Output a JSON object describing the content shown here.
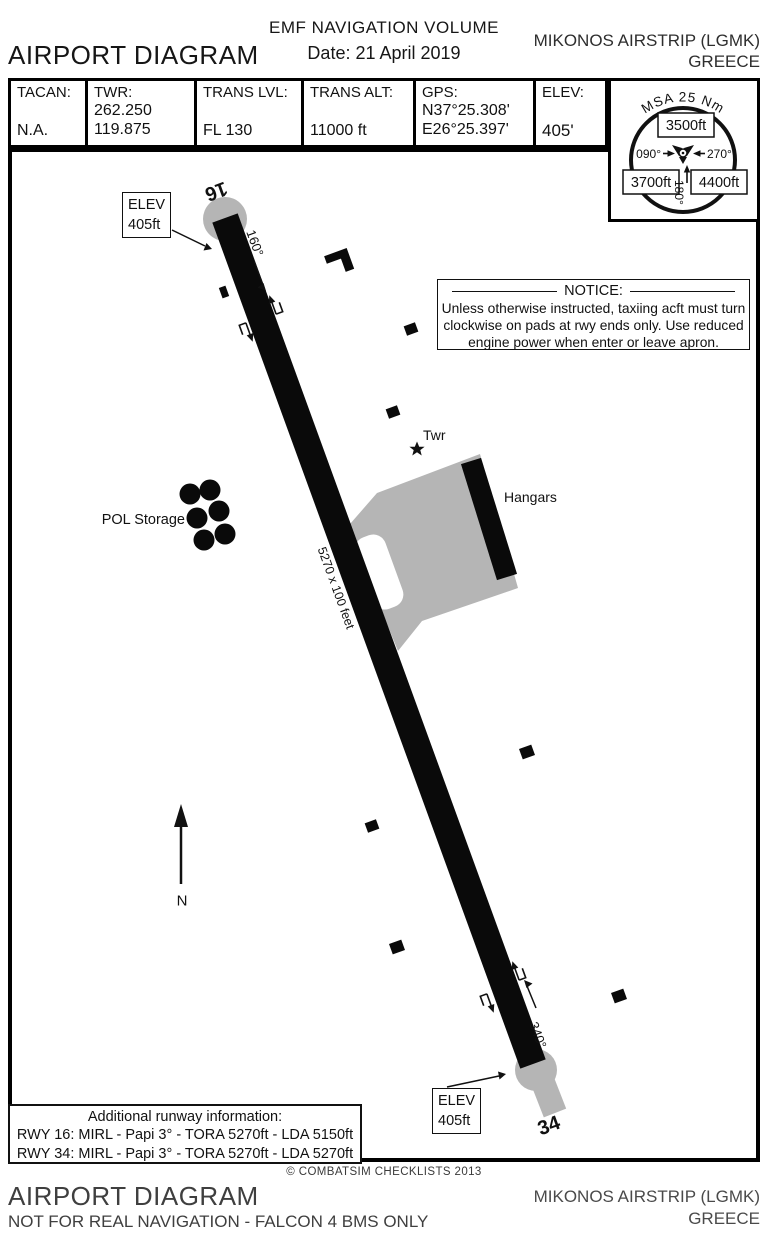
{
  "header": {
    "volume_title": "EMF NAVIGATION VOLUME",
    "date_label": "Date:",
    "date_value": "21 April 2019",
    "page_title": "AIRPORT DIAGRAM",
    "airport_name": "MIKONOS AIRSTRIP (LGMK)",
    "country": "GREECE"
  },
  "info_table": {
    "tacan_label": "TACAN:",
    "tacan_value": "N.A.",
    "twr_label": "TWR:",
    "twr_freq_uhf": "262.250",
    "twr_freq_vhf": "119.875",
    "trans_lvl_label": "TRANS LVL:",
    "trans_lvl_value": "FL 130",
    "trans_alt_label": "TRANS ALT:",
    "trans_alt_value": "11000 ft",
    "gps_label": "GPS:",
    "gps_lat": "N37°25.308'",
    "gps_lon": "E26°25.397'",
    "elev_label": "ELEV:",
    "elev_value": "405'"
  },
  "msa": {
    "title": "MSA 25 Nm",
    "sector_north": "3500ft",
    "bearing_west": "090°",
    "bearing_east": "270°",
    "sector_southwest": "3700ft",
    "sector_southeast": "4400ft",
    "bearing_south": "180°"
  },
  "map": {
    "rwy16_label": "16",
    "rwy34_label": "34",
    "rwy16_heading": "160°",
    "rwy34_heading": "340°",
    "runway_dimensions": "5270 x 100 feet",
    "elev_line1": "ELEV",
    "elev_line2": "405ft",
    "pol_label": "POL Storage",
    "twr_label": "Twr",
    "hangars_label": "Hangars",
    "north_label": "N",
    "notice_title": "NOTICE:",
    "notice_line1": "Unless otherwise instructed, taxiing acft must turn",
    "notice_line2": "clockwise on pads at rwy ends only. Use reduced",
    "notice_line3": "engine power when enter or leave apron.",
    "addinfo_title": "Additional runway information:",
    "addinfo_rwy16": "RWY 16: MIRL - Papi 3° - TORA 5270ft - LDA 5150ft",
    "addinfo_rwy34": "RWY 34: MIRL - Papi 3° - TORA 5270ft - LDA 5270ft"
  },
  "footer": {
    "copyright": "© COMBATSIM CHECKLISTS 2013",
    "page_title": "AIRPORT DIAGRAM",
    "disclaimer": "NOT FOR REAL NAVIGATION - FALCON 4 BMS ONLY",
    "airport_name": "MIKONOS AIRSTRIP (LGMK)",
    "country": "GREECE"
  },
  "colors": {
    "ink": "#111111",
    "pavement_gray": "#b5b5b5",
    "runway_black": "#0a0a0a"
  }
}
